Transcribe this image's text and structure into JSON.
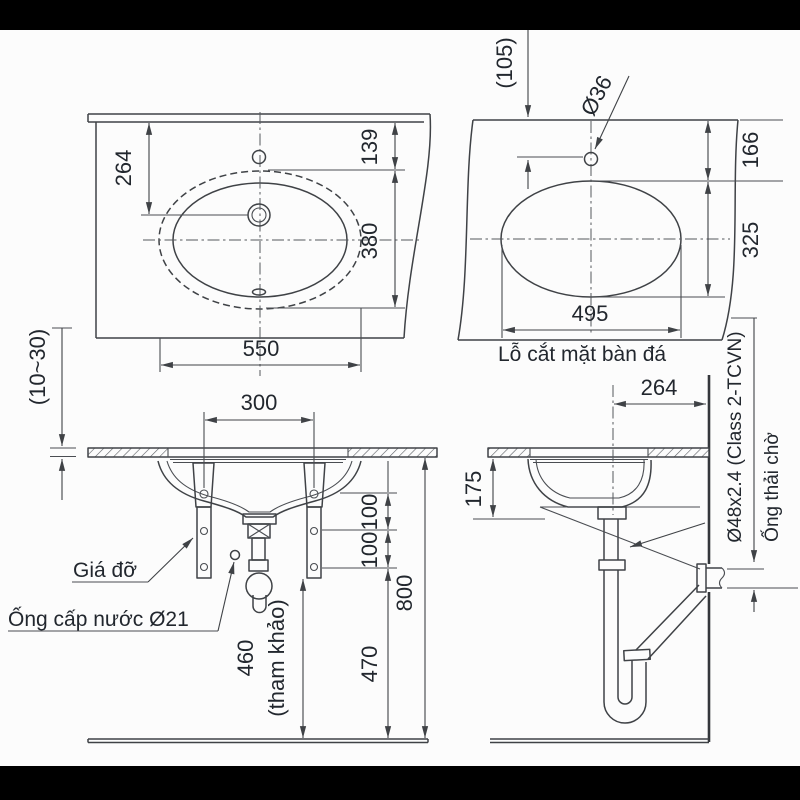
{
  "colors": {
    "line": "#3f4246",
    "text": "#22272e",
    "background": "#fcfcfc",
    "bar": "#000000"
  },
  "plan_view": {
    "dim_edge_to_drain": "264",
    "dim_edge_to_bowl": "139",
    "dim_bowl_depth": "380",
    "dim_bowl_width": "550"
  },
  "cutout_view": {
    "dim_edge_offset": "(105)",
    "faucet_hole_dia": "Ø36",
    "dim_edge_to_hole": "166",
    "dim_hole_depth": "325",
    "dim_hole_width": "495",
    "caption": "Lỗ cắt mặt bàn đá"
  },
  "front_view": {
    "dim_counter_thickness": "(10~30)",
    "dim_bracket_spacing": "300",
    "dim_hole_pitch_upper": "100",
    "dim_hole_pitch_lower": "100",
    "dim_counter_height": "800",
    "dim_trap_clearance": "470",
    "dim_ref_height": "460",
    "dim_ref_note": "(tham khảo)",
    "label_bracket": "Giá đỡ",
    "label_supply_pipe": "Ống cấp nước Ø21"
  },
  "side_view": {
    "dim_drain_to_wall": "264",
    "dim_bowl_below_counter": "175",
    "waste_pipe_spec": "Ø48x2.4 (Class 2-TCVN)",
    "label_waste_pipe": "Ống thải chờ"
  }
}
